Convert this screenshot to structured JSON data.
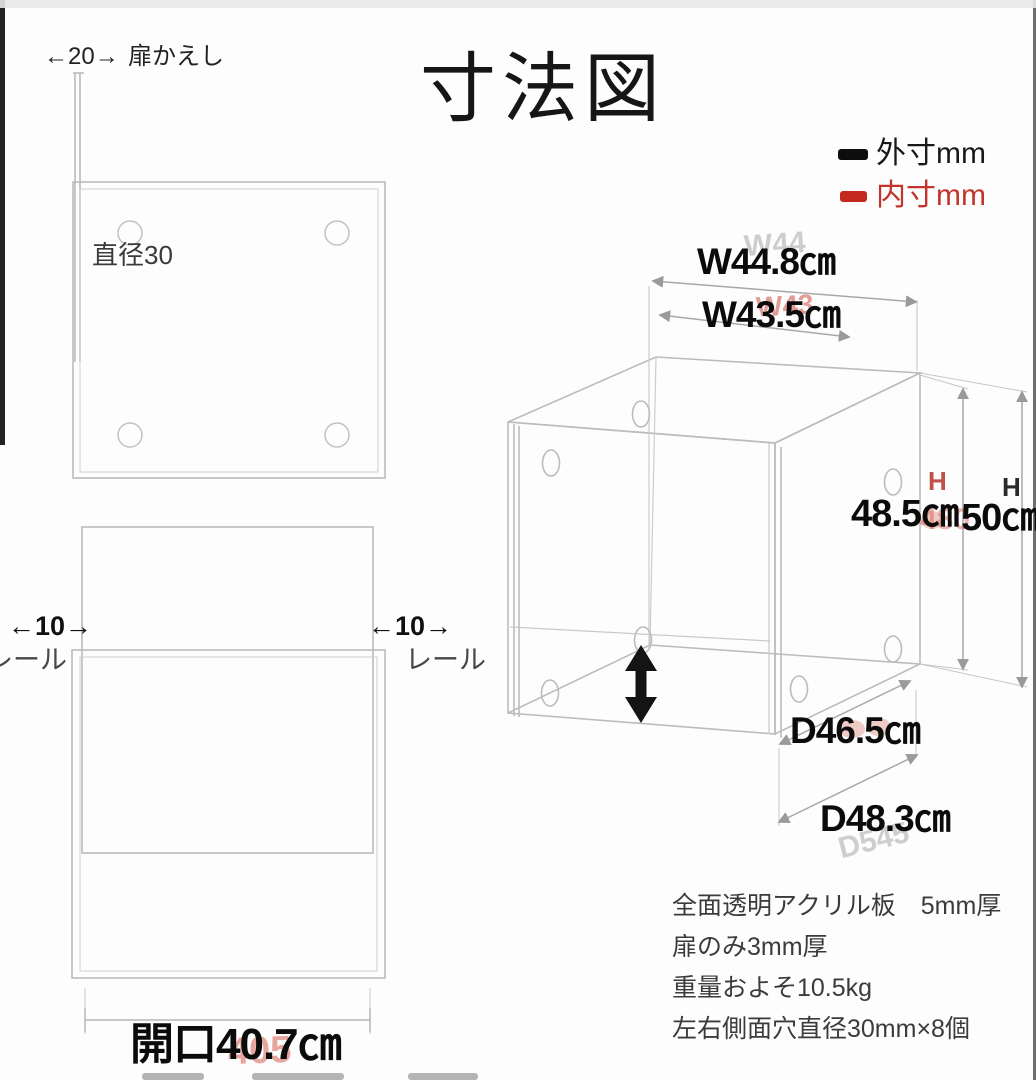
{
  "title": "寸法図",
  "legend": {
    "outer_label": "外寸mm",
    "inner_label": "内寸mm",
    "outer_color": "#111111",
    "inner_color": "#c2342c"
  },
  "side_view": {
    "return_dim": "←20→",
    "return_label": "扉かえし",
    "hole_label": "直径30"
  },
  "front_view": {
    "rail_dim_left": "←10→",
    "rail_dim_right": "←10→",
    "rail_label_left": "レール",
    "rail_label_right": "レール",
    "opening_label": "開口40.7㎝"
  },
  "iso_view": {
    "width_outer": "W44.8㎝",
    "width_inner": "W43.5㎝",
    "height_label_inner": "H",
    "height_label_outer": "H",
    "height_inner": "48.5㎝",
    "height_outer": "50㎝",
    "depth_inner": "D46.5㎝",
    "depth_outer": "D48.3㎝"
  },
  "notes": [
    "全面透明アクリル板　5mm厚",
    "扉のみ3mm厚",
    "重量およそ10.5kg",
    "左右側面穴直径30mm×8個"
  ],
  "remnants": {
    "width_outer": "W44",
    "width_inner": "W43",
    "height_inner": "480",
    "depth_outer": "D545",
    "opening": "405"
  }
}
